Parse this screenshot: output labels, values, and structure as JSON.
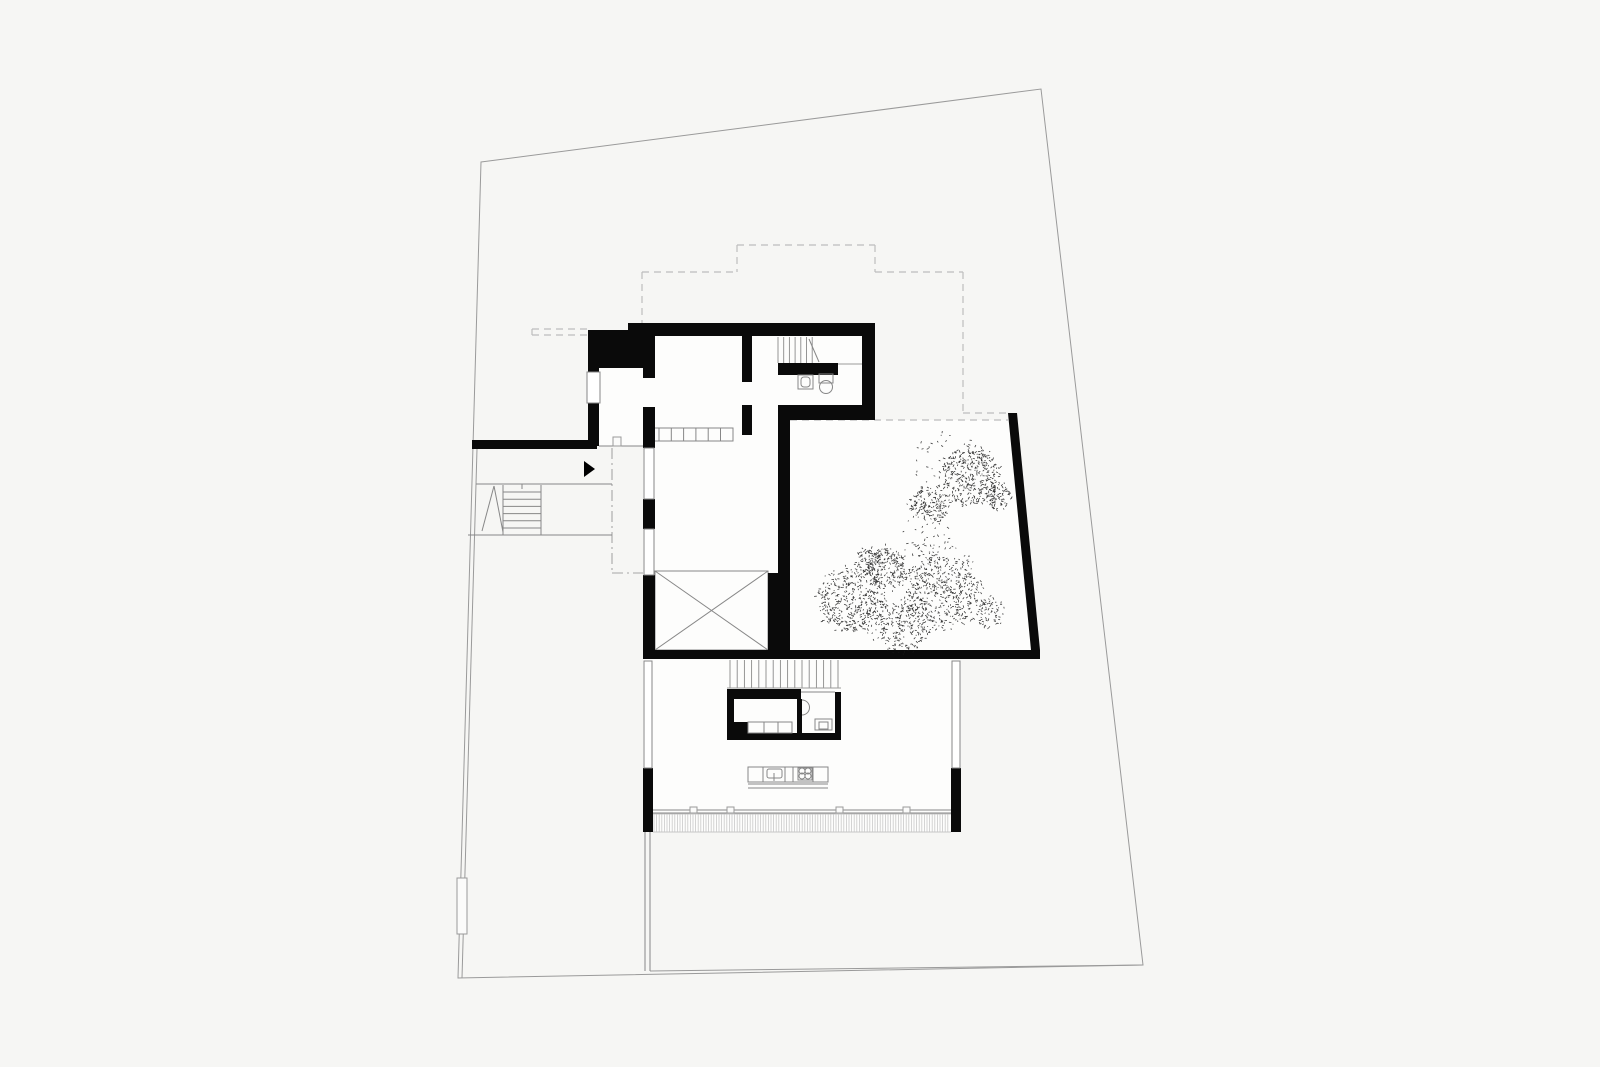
{
  "document": {
    "title": "architectural-floor-plan",
    "type": "site-and-floor-plan-drawing"
  },
  "styles": {
    "floor": {
      "fill": "#fdfdfc"
    },
    "wall": {
      "fill": "#0a0a0a"
    },
    "arrow": {
      "fill": "#000000"
    },
    "site": {
      "stroke": "#9a9a9a",
      "w": 1
    },
    "line": {
      "stroke": "#878787",
      "w": 1
    },
    "thin": {
      "stroke": "#9a9a9a",
      "w": 0.9
    },
    "light": {
      "stroke": "#c6c6c6",
      "w": 0.9
    },
    "dashed": {
      "stroke": "#bdbdbd",
      "w": 1.2,
      "dash": "7 5"
    },
    "dashdot": {
      "stroke": "#a6a6a6",
      "w": 1.1,
      "dash": "11 4 2 4"
    },
    "window": {
      "fill": "#ffffff",
      "stroke": "#878787",
      "w": 1
    },
    "outline": {
      "fill": "none",
      "stroke": "#878787",
      "w": 1
    },
    "whitebox": {
      "fill": "#fbfbfa",
      "stroke": "#9a9a9a",
      "w": 1
    },
    "hatchln": {
      "stroke": "#c9c9c9",
      "w": 0.8
    },
    "riser": {
      "stroke": "#8a8a8a",
      "w": 0.9
    }
  },
  "seed": 1234,
  "primitives": [
    {
      "n": "upper-block-floor",
      "t": "rect",
      "s": "floor",
      "d": [
        588,
        330,
        287,
        116
      ]
    },
    {
      "n": "hall-floor",
      "t": "rect",
      "s": "floor",
      "d": [
        643,
        420,
        147,
        239
      ]
    },
    {
      "n": "courtyard-floor",
      "t": "poly",
      "s": "floor",
      "d": [
        [
          790,
          420
        ],
        [
          1013,
          420
        ],
        [
          1039,
          650
        ],
        [
          790,
          650
        ]
      ]
    },
    {
      "n": "living-floor",
      "t": "rect",
      "s": "floor",
      "d": [
        643,
        659,
        317,
        173
      ]
    },
    {
      "n": "site-boundary",
      "t": "poly",
      "s": "site",
      "d": [
        [
          481,
          162
        ],
        [
          1041,
          89
        ],
        [
          1143,
          965
        ],
        [
          458,
          978
        ]
      ],
      "open": false,
      "nofill": true
    },
    {
      "n": "site-inner-bottom-line",
      "t": "line",
      "s": "site",
      "d": [
        650,
        971,
        1143,
        965
      ]
    },
    {
      "n": "site-inner-west-line",
      "t": "line",
      "s": "site",
      "d": [
        477,
        449,
        462,
        978
      ]
    },
    {
      "n": "upper-floor-outline-dash-1",
      "t": "line",
      "s": "dashed",
      "d": [
        642,
        272,
        642,
        323
      ]
    },
    {
      "n": "upper-floor-outline-dash-2",
      "t": "line",
      "s": "dashed",
      "d": [
        642,
        272,
        737,
        272
      ]
    },
    {
      "n": "upper-floor-outline-dash-3",
      "t": "line",
      "s": "dashed",
      "d": [
        737,
        245,
        737,
        272
      ]
    },
    {
      "n": "upper-floor-outline-dash-4",
      "t": "line",
      "s": "dashed",
      "d": [
        737,
        245,
        875,
        245
      ]
    },
    {
      "n": "upper-floor-outline-dash-5",
      "t": "line",
      "s": "dashed",
      "d": [
        875,
        245,
        875,
        272
      ]
    },
    {
      "n": "upper-floor-outline-dash-6",
      "t": "line",
      "s": "dashed",
      "d": [
        875,
        272,
        963,
        272
      ]
    },
    {
      "n": "upper-floor-outline-dash-7",
      "t": "line",
      "s": "dashed",
      "d": [
        963,
        272,
        963,
        413
      ]
    },
    {
      "n": "upper-floor-outline-dash-8",
      "t": "line",
      "s": "dashed",
      "d": [
        963,
        413,
        1008,
        413
      ]
    },
    {
      "n": "courtyard-roof-edge-dash",
      "t": "line",
      "s": "dashed",
      "d": [
        790,
        420,
        1008,
        420
      ]
    },
    {
      "n": "canopy-stub-dash-top",
      "t": "line",
      "s": "dashed",
      "d": [
        532,
        329,
        588,
        329
      ]
    },
    {
      "n": "canopy-stub-dash-bottom",
      "t": "line",
      "s": "dashed",
      "d": [
        532,
        335,
        588,
        335
      ]
    },
    {
      "n": "canopy-stub-dash-cap",
      "t": "line",
      "s": "dashed",
      "d": [
        532,
        329,
        532,
        335
      ]
    },
    {
      "n": "entry-canopy-dashdot-v",
      "t": "line",
      "s": "dashdot",
      "d": [
        612,
        448,
        612,
        573
      ]
    },
    {
      "n": "entry-canopy-dashdot-h",
      "t": "line",
      "s": "dashdot",
      "d": [
        612,
        573,
        643,
        573
      ]
    },
    {
      "n": "exterior-stair-top-edge",
      "t": "line",
      "s": "line",
      "d": [
        476,
        484,
        612,
        484
      ]
    },
    {
      "n": "exterior-stair-bottom-edge",
      "t": "line",
      "s": "line",
      "d": [
        468,
        535,
        612,
        535
      ]
    },
    {
      "n": "exterior-stair-left-edge",
      "t": "line",
      "s": "line",
      "d": [
        503,
        485,
        503,
        535
      ]
    },
    {
      "n": "exterior-stair-tread-edge",
      "t": "line",
      "s": "line",
      "d": [
        541,
        485,
        541,
        535
      ]
    },
    {
      "n": "exterior-stair-treads",
      "t": "hruns",
      "s": "line",
      "d": [
        503,
        541,
        492,
        6,
        7.2
      ]
    },
    {
      "n": "exterior-stair-break-line-a",
      "t": "line",
      "s": "line",
      "d": [
        482,
        531,
        494,
        486
      ]
    },
    {
      "n": "exterior-stair-break-line-b",
      "t": "line",
      "s": "line",
      "d": [
        494,
        486,
        503,
        532
      ]
    },
    {
      "n": "exterior-stair-tick",
      "t": "line",
      "s": "line",
      "d": [
        522,
        484,
        522,
        489
      ]
    },
    {
      "n": "vestibule-front-line",
      "t": "line",
      "s": "line",
      "d": [
        599,
        446,
        643,
        446
      ]
    },
    {
      "n": "entry-threshold",
      "t": "rect",
      "s": "whitebox",
      "d": [
        613,
        437,
        8,
        9
      ]
    },
    {
      "n": "interior-steps-box",
      "t": "rect",
      "s": "outline",
      "d": [
        647,
        428,
        86,
        13
      ]
    },
    {
      "n": "interior-steps-treads",
      "t": "vruns",
      "s": "line",
      "d": [
        659,
        428,
        441,
        6,
        12.3
      ]
    },
    {
      "n": "void-room-outline",
      "t": "rect",
      "s": "outline",
      "d": [
        655,
        571,
        113,
        79
      ]
    },
    {
      "n": "void-room-diagonal-a",
      "t": "line",
      "s": "line",
      "d": [
        655,
        571,
        768,
        650
      ]
    },
    {
      "n": "void-room-diagonal-b",
      "t": "line",
      "s": "line",
      "d": [
        655,
        650,
        768,
        571
      ]
    },
    {
      "n": "facade-hatch-top-edge",
      "t": "line",
      "s": "light",
      "d": [
        653,
        814,
        951,
        814
      ]
    },
    {
      "n": "facade-hatch-bottom-edge",
      "t": "line",
      "s": "light",
      "d": [
        653,
        832,
        951,
        832
      ]
    },
    {
      "n": "deck-hatch",
      "t": "hatch",
      "s": "hatchln",
      "d": [
        654,
        950,
        814,
        832,
        2.6
      ]
    },
    {
      "n": "facade-glass-line-a",
      "t": "line",
      "s": "line",
      "d": [
        653,
        810,
        951,
        810
      ]
    },
    {
      "n": "facade-glass-line-b",
      "t": "line",
      "s": "line",
      "d": [
        653,
        813,
        951,
        813
      ]
    },
    {
      "n": "facade-mullion-1",
      "t": "rect",
      "s": "whitebox",
      "d": [
        690,
        807,
        7,
        6
      ]
    },
    {
      "n": "facade-mullion-2",
      "t": "rect",
      "s": "whitebox",
      "d": [
        727,
        807,
        7,
        6
      ]
    },
    {
      "n": "facade-mullion-3",
      "t": "rect",
      "s": "whitebox",
      "d": [
        836,
        807,
        7,
        6
      ]
    },
    {
      "n": "facade-mullion-4",
      "t": "rect",
      "s": "whitebox",
      "d": [
        903,
        807,
        7,
        6
      ]
    },
    {
      "n": "garden-fence-line-a",
      "t": "line",
      "s": "line",
      "d": [
        645,
        832,
        645,
        971
      ]
    },
    {
      "n": "garden-fence-line-b",
      "t": "line",
      "s": "line",
      "d": [
        650,
        832,
        650,
        971
      ]
    },
    {
      "n": "garden-gate",
      "t": "rect",
      "s": "whitebox",
      "d": [
        457,
        878,
        10,
        56
      ]
    },
    {
      "n": "top-wall",
      "t": "rect",
      "s": "wall",
      "d": [
        628,
        323,
        247,
        13
      ]
    },
    {
      "n": "entry-core-wall",
      "t": "rect",
      "s": "wall",
      "d": [
        588,
        330,
        67,
        38
      ]
    },
    {
      "n": "vestibule-west-wall",
      "t": "rect",
      "s": "wall",
      "d": [
        588,
        368,
        11,
        78
      ]
    },
    {
      "n": "hall-west-wall-a",
      "t": "rect",
      "s": "wall",
      "d": [
        643,
        368,
        12,
        10
      ]
    },
    {
      "n": "hall-west-wall-b",
      "t": "rect",
      "s": "wall",
      "d": [
        643,
        407,
        12,
        41
      ]
    },
    {
      "n": "hall-west-wall-c",
      "t": "rect",
      "s": "wall",
      "d": [
        643,
        499,
        12,
        30
      ]
    },
    {
      "n": "hall-west-wall-d",
      "t": "rect",
      "s": "wall",
      "d": [
        643,
        575,
        12,
        84
      ]
    },
    {
      "n": "stairhall-wall-upper",
      "t": "rect",
      "s": "wall",
      "d": [
        742,
        336,
        10,
        46
      ]
    },
    {
      "n": "stairhall-wall-lower",
      "t": "rect",
      "s": "wall",
      "d": [
        742,
        405,
        10,
        30
      ]
    },
    {
      "n": "east-wall-upper",
      "t": "rect",
      "s": "wall",
      "d": [
        862,
        323,
        13,
        97
      ]
    },
    {
      "n": "upper-south-wall",
      "t": "rect",
      "s": "wall",
      "d": [
        778,
        405,
        97,
        15
      ]
    },
    {
      "n": "bath-partition-bar",
      "t": "rect",
      "s": "wall",
      "d": [
        778,
        363,
        60,
        12
      ]
    },
    {
      "n": "courtyard-west-wall",
      "t": "rect",
      "s": "wall",
      "d": [
        778,
        420,
        12,
        239
      ]
    },
    {
      "n": "void-east-wall",
      "t": "rect",
      "s": "wall",
      "d": [
        768,
        573,
        22,
        86
      ]
    },
    {
      "n": "south-band-wall",
      "t": "rect",
      "s": "wall",
      "d": [
        643,
        650,
        397,
        9
      ]
    },
    {
      "n": "courtyard-east-wall",
      "t": "poly",
      "s": "wall",
      "d": [
        [
          1008,
          413
        ],
        [
          1017,
          413
        ],
        [
          1040,
          650
        ],
        [
          1031,
          650
        ]
      ]
    },
    {
      "n": "living-west-pier",
      "t": "rect",
      "s": "wall",
      "d": [
        643,
        768,
        10,
        64
      ]
    },
    {
      "n": "living-east-pier",
      "t": "rect",
      "s": "wall",
      "d": [
        951,
        768,
        10,
        64
      ]
    },
    {
      "n": "garden-wall-west",
      "t": "rect",
      "s": "wall",
      "d": [
        472,
        440,
        125,
        9
      ]
    },
    {
      "n": "utility-top-wall",
      "t": "rect",
      "s": "wall",
      "d": [
        727,
        689,
        74,
        10
      ]
    },
    {
      "n": "utility-west-wall",
      "t": "rect",
      "s": "wall",
      "d": [
        727,
        699,
        7,
        34
      ]
    },
    {
      "n": "utility-sw-block",
      "t": "rect",
      "s": "wall",
      "d": [
        734,
        722,
        14,
        11
      ]
    },
    {
      "n": "utility-divider-wall",
      "t": "rect",
      "s": "wall",
      "d": [
        797,
        699,
        5,
        34
      ]
    },
    {
      "n": "wc-east-wall",
      "t": "rect",
      "s": "wall",
      "d": [
        835,
        692,
        6,
        48
      ]
    },
    {
      "n": "utility-bottom-wall",
      "t": "rect",
      "s": "wall",
      "d": [
        727,
        733,
        114,
        7
      ]
    },
    {
      "n": "window-vestibule-west",
      "t": "rect",
      "s": "window",
      "d": [
        587,
        372,
        13,
        31
      ]
    },
    {
      "n": "window-hall-west-a",
      "t": "rect",
      "s": "window",
      "d": [
        644,
        448,
        10,
        51
      ]
    },
    {
      "n": "window-hall-west-b",
      "t": "rect",
      "s": "window",
      "d": [
        644,
        529,
        10,
        46
      ]
    },
    {
      "n": "window-living-west",
      "t": "rect",
      "s": "window",
      "d": [
        644,
        661,
        8,
        107
      ]
    },
    {
      "n": "window-living-east",
      "t": "rect",
      "s": "window",
      "d": [
        952,
        661,
        8,
        107
      ]
    },
    {
      "n": "upper-stair-risers",
      "t": "vruns",
      "s": "riser",
      "d": [
        778,
        337,
        363,
        7,
        5.7
      ]
    },
    {
      "n": "upper-stair-direction-line",
      "t": "line",
      "s": "line",
      "d": [
        809,
        339,
        819,
        362
      ]
    },
    {
      "n": "upper-stair-edge-line",
      "t": "line",
      "s": "thin",
      "d": [
        838,
        364,
        862,
        364
      ]
    },
    {
      "n": "bath-sink",
      "t": "rect",
      "s": "outline",
      "d": [
        798,
        375,
        15,
        14
      ]
    },
    {
      "n": "bath-sink-basin",
      "t": "rect",
      "s": "outline",
      "d": [
        801,
        377,
        9,
        10
      ],
      "rx": 3
    },
    {
      "n": "bath-toilet-tank",
      "t": "rect",
      "s": "outline",
      "d": [
        819,
        374,
        14,
        9
      ]
    },
    {
      "n": "bath-toilet-bowl",
      "t": "circle",
      "s": "outline",
      "d": [
        826,
        387,
        6.5
      ]
    },
    {
      "n": "lower-stair-risers",
      "t": "vruns",
      "s": "riser",
      "d": [
        730,
        660,
        688,
        16,
        7.2
      ]
    },
    {
      "n": "lower-stair-edge",
      "t": "line",
      "s": "thin",
      "d": [
        727,
        688,
        841,
        688
      ]
    },
    {
      "n": "wc-top-line",
      "t": "line",
      "s": "line",
      "d": [
        801,
        692,
        835,
        692
      ]
    },
    {
      "n": "wc-sink-bowl",
      "t": "path",
      "s": "outline",
      "d": "M802,700 A7.5,7.5 0 0 1 802,715"
    },
    {
      "n": "wc-shower-box",
      "t": "rect",
      "s": "outline",
      "d": [
        815,
        719,
        17,
        11
      ]
    },
    {
      "n": "wc-shower-inner",
      "t": "rect",
      "s": "outline",
      "d": [
        819,
        722,
        9,
        7
      ]
    },
    {
      "n": "pantry-cabinet-1",
      "t": "rect",
      "s": "outline",
      "d": [
        748,
        722,
        16,
        11
      ]
    },
    {
      "n": "pantry-cabinet-2",
      "t": "rect",
      "s": "outline",
      "d": [
        764,
        722,
        14,
        11
      ]
    },
    {
      "n": "pantry-cabinet-3",
      "t": "rect",
      "s": "outline",
      "d": [
        778,
        722,
        14,
        11
      ]
    },
    {
      "n": "kitchen-island",
      "t": "rect",
      "s": "outline",
      "d": [
        748,
        767,
        80,
        15
      ]
    },
    {
      "n": "kitchen-island-divider-1",
      "t": "line",
      "s": "line",
      "d": [
        763,
        767,
        763,
        782
      ]
    },
    {
      "n": "kitchen-island-divider-2",
      "t": "line",
      "s": "line",
      "d": [
        785,
        767,
        785,
        782
      ]
    },
    {
      "n": "kitchen-island-divider-3",
      "t": "line",
      "s": "line",
      "d": [
        793,
        767,
        793,
        782
      ]
    },
    {
      "n": "kitchen-island-divider-4",
      "t": "line",
      "s": "line",
      "d": [
        813,
        767,
        813,
        782
      ]
    },
    {
      "n": "kitchen-sink",
      "t": "rect",
      "s": "outline",
      "d": [
        767,
        769,
        15,
        9
      ],
      "rx": 2
    },
    {
      "n": "kitchen-tap",
      "t": "line",
      "s": "line",
      "d": [
        774,
        773,
        774,
        781
      ]
    },
    {
      "n": "kitchen-cooktop",
      "t": "rect",
      "s": "outline",
      "d": [
        798,
        768,
        14,
        12
      ]
    },
    {
      "n": "kitchen-burner-1",
      "t": "circle",
      "s": "outline",
      "d": [
        802,
        771,
        3
      ]
    },
    {
      "n": "kitchen-burner-2",
      "t": "circle",
      "s": "outline",
      "d": [
        808,
        771,
        3
      ]
    },
    {
      "n": "kitchen-burner-3",
      "t": "circle",
      "s": "outline",
      "d": [
        802,
        776,
        3
      ]
    },
    {
      "n": "kitchen-burner-4",
      "t": "circle",
      "s": "outline",
      "d": [
        808,
        776,
        3
      ]
    },
    {
      "n": "kitchen-counter-line-a",
      "t": "line",
      "s": "line",
      "d": [
        748,
        784,
        828,
        784
      ]
    },
    {
      "n": "kitchen-counter-line-b",
      "t": "line",
      "s": "line",
      "d": [
        748,
        788,
        828,
        788
      ]
    },
    {
      "n": "entry-arrow",
      "t": "poly",
      "s": "arrow",
      "d": [
        [
          584,
          461
        ],
        [
          595,
          469
        ],
        [
          584,
          477
        ]
      ]
    }
  ],
  "trees": [
    {
      "n": "courtyard-tree-small",
      "blobs": [
        [
          929,
          505,
          20,
          160
        ],
        [
          971,
          477,
          31,
          340
        ],
        [
          999,
          497,
          15,
          85
        ],
        [
          952,
          466,
          38,
          70
        ]
      ]
    },
    {
      "n": "courtyard-tree-large",
      "blobs": [
        [
          852,
          599,
          35,
          400
        ],
        [
          887,
          567,
          21,
          180
        ],
        [
          943,
          591,
          41,
          470
        ],
        [
          903,
          627,
          27,
          200
        ],
        [
          897,
          592,
          52,
          100
        ],
        [
          988,
          612,
          17,
          70
        ],
        [
          868,
          560,
          14,
          60
        ],
        [
          930,
          540,
          28,
          45
        ]
      ]
    }
  ]
}
